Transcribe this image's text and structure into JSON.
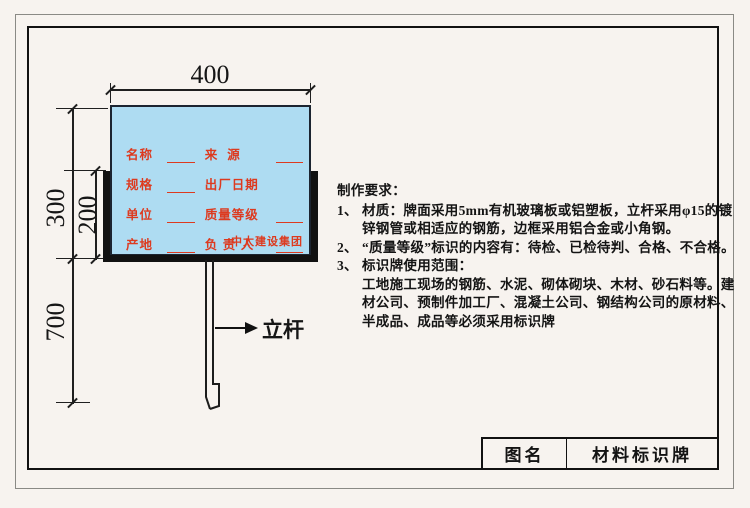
{
  "colors": {
    "paper": "#f7f3ef",
    "board": "#aedcf2",
    "accent": "#dd3a1f",
    "line": "#1f1f1f",
    "frame": "#111111"
  },
  "drawing": {
    "dimensions": {
      "width": "400",
      "board_height": "300",
      "frame_height": "200",
      "pole_height": "700"
    },
    "pole_label": "立杆",
    "board": {
      "brand": "中太建设集团",
      "rows": [
        {
          "label_left": "名称",
          "label_right": "来  源"
        },
        {
          "label_left": "规格",
          "label_right": "出厂日期"
        },
        {
          "label_left": "单位",
          "label_right": "质量等级"
        },
        {
          "label_left": "产地",
          "label_right": "负 责 人"
        }
      ]
    }
  },
  "requirements": {
    "heading": "制作要求：",
    "items": [
      {
        "no": "1、",
        "text": "材质：牌面采用5mm有机玻璃板或铝塑板，立杆采用φ15的镀锌钢管或相适应的钢筋，边框采用铝合金或小角钢。"
      },
      {
        "no": "2、",
        "text": "“质量等级”标识的内容有：待检、已检待判、合格、不合格。"
      },
      {
        "no": "3、",
        "text": "标识牌使用范围：",
        "body": "工地施工现场的钢筋、水泥、砌体砌块、木材、砂石料等。建材公司、预制件加工厂、混凝土公司、钢结构公司的原材料、半成品、成品等必须采用标识牌"
      }
    ]
  },
  "title_block": {
    "label": "图名",
    "value": "材料标识牌"
  }
}
